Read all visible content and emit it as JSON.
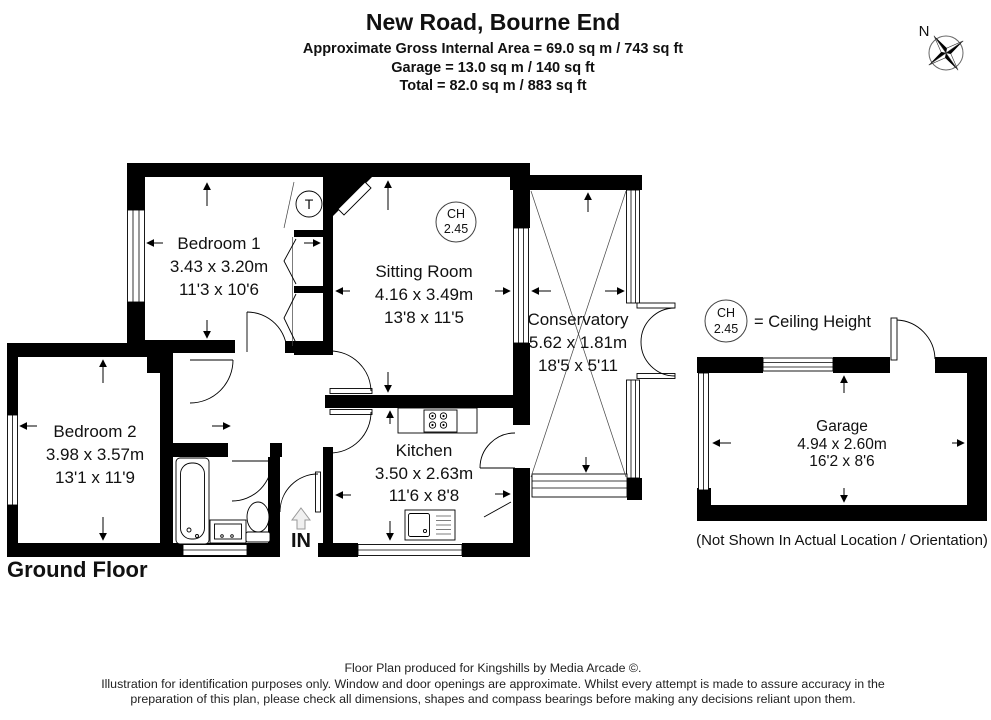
{
  "header": {
    "title": "New Road, Bourne End",
    "area_lines": [
      "Approximate Gross Internal Area  = 69.0 sq m / 743 sq ft",
      "Garage = 13.0 sq m / 140 sq ft",
      "Total = 82.0 sq m / 883 sq ft"
    ]
  },
  "compass": {
    "north": "N"
  },
  "legend": {
    "ch_abbr": "CH",
    "ch_value": "2.45",
    "meaning": "= Ceiling Height"
  },
  "rooms": {
    "bedroom1": {
      "name": "Bedroom 1",
      "metric": "3.43 x 3.20m",
      "imperial": "11'3 x 10'6"
    },
    "sitting_room": {
      "name": "Sitting Room",
      "metric": "4.16 x 3.49m",
      "imperial": "13'8 x 11'5"
    },
    "conservatory": {
      "name": "Conservatory",
      "metric": "5.62 x 1.81m",
      "imperial": "18'5 x 5'11"
    },
    "bedroom2": {
      "name": "Bedroom 2",
      "metric": "3.98 x 3.57m",
      "imperial": "13'1 x 11'9"
    },
    "kitchen": {
      "name": "Kitchen",
      "metric": "3.50 x 2.63m",
      "imperial": "11'6 x 8'8"
    },
    "garage": {
      "name": "Garage",
      "metric": "4.94 x 2.60m",
      "imperial": "16'2 x 8'6",
      "note": "(Not Shown In Actual Location / Orientation)"
    }
  },
  "labels": {
    "floor": "Ground Floor",
    "entrance": "IN",
    "tank": "T",
    "ceiling_height_abbr": "CH",
    "ceiling_height_value": "2.45"
  },
  "footer": {
    "line1": "Floor Plan produced for Kingshills by Media Arcade ©.",
    "line2": "Illustration for identification purposes only. Window and door openings are approximate. Whilst every attempt is made to assure accuracy in the",
    "line3": "preparation of this plan, please check all dimensions, shapes and compass bearings before making any decisions reliant upon them."
  },
  "colors": {
    "walls": "#000000",
    "text": "#111111",
    "background": "#ffffff"
  }
}
